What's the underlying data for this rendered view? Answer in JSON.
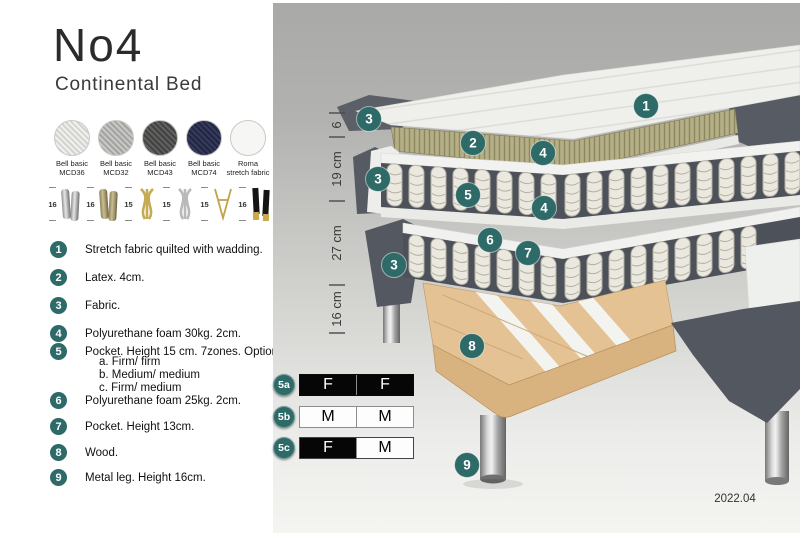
{
  "header": {
    "title": "No4",
    "subtitle": "Continental Bed"
  },
  "swatches": [
    {
      "name": "fabric-bell-basic-mcd36",
      "label_line1": "Bell basic",
      "label_line2": "MCD36"
    },
    {
      "name": "fabric-bell-basic-mcd32",
      "label_line1": "Bell basic",
      "label_line2": "MCD32"
    },
    {
      "name": "fabric-bell-basic-mcd43",
      "label_line1": "Bell basic",
      "label_line2": "MCD43"
    },
    {
      "name": "fabric-bell-basic-mcd74",
      "label_line1": "Bell basic",
      "label_line2": "MCD74"
    },
    {
      "name": "fabric-roma-stretch",
      "label_line1": "Roma",
      "label_line2": "stretch fabric"
    }
  ],
  "legs": [
    {
      "name": "chrome-cylinder-leg",
      "height": "16"
    },
    {
      "name": "brass-cylinder-leg",
      "height": "16"
    },
    {
      "name": "gold-twisted-leg",
      "height": "15"
    },
    {
      "name": "silver-twisted-leg",
      "height": "15"
    },
    {
      "name": "gold-hairpin-leg",
      "height": "15"
    },
    {
      "name": "black-gold-leg",
      "height": "16"
    }
  ],
  "features": [
    {
      "num": "1",
      "text": "Stretch fabric quilted with wadding."
    },
    {
      "num": "2",
      "text": "Latex. 4cm."
    },
    {
      "num": "3",
      "text": "Fabric."
    },
    {
      "num": "4",
      "text": "Polyurethane foam 30kg. 2cm."
    },
    {
      "num": "5",
      "text": "Pocket. Height 15 cm. 7zones. Option:",
      "options": [
        "a. Firm/ firm",
        "b. Medium/ medium",
        "c. Firm/ medium"
      ]
    },
    {
      "num": "6",
      "text": "Polyurethane foam 25kg. 2cm."
    },
    {
      "num": "7",
      "text": "Pocket. Height 13cm."
    },
    {
      "num": "8",
      "text": "Wood."
    },
    {
      "num": "9",
      "text": "Metal leg. Height 16cm."
    }
  ],
  "diagram": {
    "dimensions": [
      "6",
      "19 cm",
      "27 cm",
      "16 cm"
    ],
    "callouts": {
      "one": "1",
      "two": "2",
      "three": "3",
      "four": "4",
      "five": "5",
      "six": "6",
      "seven": "7",
      "eight": "8",
      "nine": "9"
    },
    "firmness": [
      {
        "id": "5a",
        "left": "F",
        "right": "F"
      },
      {
        "id": "5b",
        "left": "M",
        "right": "M"
      },
      {
        "id": "5c",
        "left": "F",
        "right": "M"
      }
    ],
    "version": "2022.04"
  },
  "colors": {
    "accent_teal": "#2e6a68",
    "fabric_dark": "#565a62",
    "latex_tan": "#b5af88",
    "wood": "#e4c294"
  }
}
